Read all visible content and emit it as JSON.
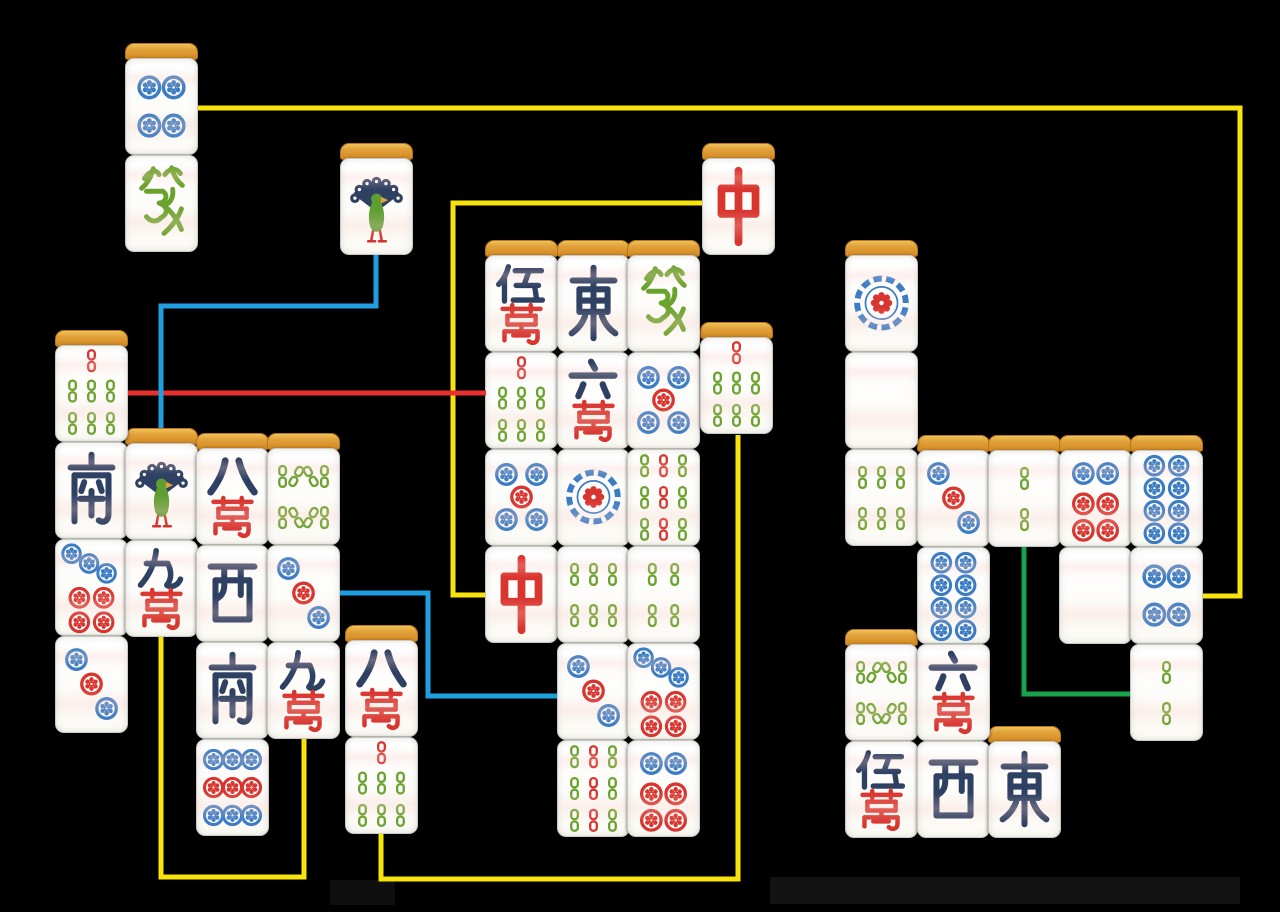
{
  "board": {
    "width": 1280,
    "height": 912,
    "background": "#000000",
    "tile_width": 73,
    "tile_face_height": 97,
    "tile_cap_height": 15
  },
  "palette": {
    "face": "#fdfdfa",
    "cap": "#dd9433",
    "cap_border": "#b5761c",
    "navy": "#2f4163",
    "red": "#d9352f",
    "green": "#6aa32c",
    "bird_green": "#5f9e31",
    "blue": "#3b7cc4",
    "beak_orange": "#e1a33c",
    "leg_red": "#d2332c",
    "line_yellow": "#f8e40a",
    "line_red": "#e8302e",
    "line_blue": "#1f9fe0",
    "line_green": "#18a24c"
  },
  "tiles": [
    {
      "name": "pin-4",
      "label": "4 circles",
      "kind": "pin",
      "value": 4,
      "x": 125,
      "y": 58,
      "cap": true
    },
    {
      "name": "green-dragon",
      "label": "green dragon",
      "kind": "char",
      "char": "發",
      "x": 125,
      "y": 155,
      "cap": false
    },
    {
      "name": "sou-1",
      "label": "1 bamboo bird",
      "kind": "bird",
      "value": 1,
      "x": 340,
      "y": 158,
      "cap": true
    },
    {
      "name": "red-dragon",
      "label": "red dragon",
      "kind": "char",
      "char": "中",
      "x": 702,
      "y": 158,
      "cap": true
    },
    {
      "name": "sou-7",
      "label": "7 bamboo",
      "kind": "sou",
      "value": 7,
      "x": 55,
      "y": 345,
      "cap": true
    },
    {
      "name": "south-wind",
      "label": "south wind",
      "kind": "char",
      "char": "南",
      "x": 55,
      "y": 442,
      "cap": false
    },
    {
      "name": "pin-7",
      "label": "7 circles",
      "kind": "pin",
      "value": 7,
      "x": 55,
      "y": 539,
      "cap": false
    },
    {
      "name": "pin-3",
      "label": "3 circles",
      "kind": "pin",
      "value": 3,
      "x": 55,
      "y": 636,
      "cap": false
    },
    {
      "name": "sou-1",
      "label": "1 bamboo bird",
      "kind": "bird",
      "value": 1,
      "x": 125,
      "y": 443,
      "cap": true
    },
    {
      "name": "man-9",
      "label": "9 characters",
      "kind": "man",
      "num": "九",
      "wan": "萬",
      "x": 125,
      "y": 540,
      "cap": false
    },
    {
      "name": "man-8",
      "label": "8 characters",
      "kind": "man",
      "num": "八",
      "wan": "萬",
      "x": 196,
      "y": 448,
      "cap": true
    },
    {
      "name": "west-wind",
      "label": "west wind",
      "kind": "char",
      "char": "西",
      "x": 196,
      "y": 545,
      "cap": false
    },
    {
      "name": "south-wind",
      "label": "south wind",
      "kind": "char",
      "char": "南",
      "x": 196,
      "y": 642,
      "cap": false
    },
    {
      "name": "pin-9",
      "label": "9 circles",
      "kind": "pin",
      "value": 9,
      "x": 196,
      "y": 739,
      "cap": false
    },
    {
      "name": "sou-8",
      "label": "8 bamboo",
      "kind": "sou",
      "value": 8,
      "x": 267,
      "y": 448,
      "cap": true
    },
    {
      "name": "pin-3",
      "label": "3 circles",
      "kind": "pin",
      "value": 3,
      "x": 267,
      "y": 545,
      "cap": false
    },
    {
      "name": "man-9",
      "label": "9 characters",
      "kind": "man",
      "num": "九",
      "wan": "萬",
      "x": 267,
      "y": 642,
      "cap": false
    },
    {
      "name": "man-8",
      "label": "8 characters",
      "kind": "man",
      "num": "八",
      "wan": "萬",
      "x": 345,
      "y": 640,
      "cap": true
    },
    {
      "name": "sou-7",
      "label": "7 bamboo",
      "kind": "sou",
      "value": 7,
      "x": 345,
      "y": 737,
      "cap": false
    },
    {
      "name": "man-5",
      "label": "5 characters",
      "kind": "man",
      "num": "伍",
      "wan": "萬",
      "x": 485,
      "y": 255,
      "cap": true
    },
    {
      "name": "sou-7",
      "label": "7 bamboo",
      "kind": "sou",
      "value": 7,
      "x": 485,
      "y": 352,
      "cap": false
    },
    {
      "name": "pin-5",
      "label": "5 circles",
      "kind": "pin",
      "value": 5,
      "x": 485,
      "y": 449,
      "cap": false
    },
    {
      "name": "red-dragon",
      "label": "red dragon",
      "kind": "char",
      "char": "中",
      "x": 485,
      "y": 546,
      "cap": false
    },
    {
      "name": "east-wind",
      "label": "east wind",
      "kind": "char",
      "char": "東",
      "x": 557,
      "y": 255,
      "cap": true
    },
    {
      "name": "man-6",
      "label": "6 characters",
      "kind": "man",
      "num": "六",
      "wan": "萬",
      "x": 557,
      "y": 352,
      "cap": false
    },
    {
      "name": "pin-1",
      "label": "1 circle",
      "kind": "pin",
      "value": 1,
      "x": 557,
      "y": 449,
      "cap": false
    },
    {
      "name": "sou-6",
      "label": "6 bamboo",
      "kind": "sou",
      "value": 6,
      "x": 557,
      "y": 546,
      "cap": false
    },
    {
      "name": "pin-3",
      "label": "3 circles",
      "kind": "pin",
      "value": 3,
      "x": 557,
      "y": 643,
      "cap": false
    },
    {
      "name": "sou-9",
      "label": "9 bamboo",
      "kind": "sou",
      "value": 9,
      "x": 557,
      "y": 740,
      "cap": false
    },
    {
      "name": "green-dragon",
      "label": "green dragon",
      "kind": "char",
      "char": "發",
      "x": 627,
      "y": 255,
      "cap": true
    },
    {
      "name": "pin-5",
      "label": "5 circles",
      "kind": "pin",
      "value": 5,
      "x": 627,
      "y": 352,
      "cap": false
    },
    {
      "name": "sou-9",
      "label": "9 bamboo",
      "kind": "sou",
      "value": 9,
      "x": 627,
      "y": 449,
      "cap": false
    },
    {
      "name": "sou-4",
      "label": "4 bamboo",
      "kind": "sou",
      "value": 4,
      "x": 627,
      "y": 546,
      "cap": false
    },
    {
      "name": "pin-7",
      "label": "7 circles",
      "kind": "pin",
      "value": 7,
      "x": 627,
      "y": 643,
      "cap": false
    },
    {
      "name": "pin-6",
      "label": "6 circles",
      "kind": "pin",
      "value": 6,
      "x": 627,
      "y": 740,
      "cap": false
    },
    {
      "name": "sou-7",
      "label": "7 bamboo",
      "kind": "sou",
      "value": 7,
      "x": 700,
      "y": 337,
      "cap": true
    },
    {
      "name": "pin-1",
      "label": "1 circle",
      "kind": "pin",
      "value": 1,
      "x": 845,
      "y": 255,
      "cap": true
    },
    {
      "name": "blank",
      "label": "blank white tile",
      "kind": "blank",
      "x": 845,
      "y": 352,
      "cap": false
    },
    {
      "name": "sou-6",
      "label": "6 bamboo",
      "kind": "sou",
      "value": 6,
      "x": 845,
      "y": 449,
      "cap": false
    },
    {
      "name": "sou-8",
      "label": "8 bamboo",
      "kind": "sou",
      "value": 8,
      "x": 845,
      "y": 644,
      "cap": true
    },
    {
      "name": "man-5",
      "label": "5 characters",
      "kind": "man",
      "num": "伍",
      "wan": "萬",
      "x": 845,
      "y": 741,
      "cap": false
    },
    {
      "name": "pin-3",
      "label": "3 circles",
      "kind": "pin",
      "value": 3,
      "x": 917,
      "y": 450,
      "cap": true
    },
    {
      "name": "pin-8",
      "label": "8 circles",
      "kind": "pin",
      "value": 8,
      "x": 917,
      "y": 547,
      "cap": false
    },
    {
      "name": "man-6",
      "label": "6 characters",
      "kind": "man",
      "num": "六",
      "wan": "萬",
      "x": 917,
      "y": 644,
      "cap": false
    },
    {
      "name": "west-wind",
      "label": "west wind",
      "kind": "char",
      "char": "西",
      "x": 917,
      "y": 741,
      "cap": false
    },
    {
      "name": "sou-2",
      "label": "2 bamboo",
      "kind": "sou",
      "value": 2,
      "x": 988,
      "y": 450,
      "cap": true
    },
    {
      "name": "east-wind",
      "label": "east wind",
      "kind": "char",
      "char": "東",
      "x": 988,
      "y": 741,
      "cap": true
    },
    {
      "name": "pin-6",
      "label": "6 circles",
      "kind": "pin",
      "value": 6,
      "x": 1059,
      "y": 450,
      "cap": true
    },
    {
      "name": "blank",
      "label": "blank white tile",
      "kind": "blank",
      "x": 1059,
      "y": 547,
      "cap": false
    },
    {
      "name": "pin-8",
      "label": "8 circles",
      "kind": "pin",
      "value": 8,
      "x": 1130,
      "y": 450,
      "cap": true
    },
    {
      "name": "pin-4",
      "label": "4 circles",
      "kind": "pin",
      "value": 4,
      "x": 1130,
      "y": 547,
      "cap": false
    },
    {
      "name": "sou-2",
      "label": "2 bamboo",
      "kind": "sou",
      "value": 2,
      "x": 1130,
      "y": 644,
      "cap": false
    }
  ],
  "lines": [
    {
      "name": "match-line-pin4",
      "color": "#f8e40a",
      "points": [
        [
          198,
          108
        ],
        [
          1240,
          108
        ],
        [
          1240,
          596
        ],
        [
          1203,
          596
        ]
      ]
    },
    {
      "name": "match-line-red-dragon",
      "color": "#f8e40a",
      "points": [
        [
          702,
          203
        ],
        [
          453,
          203
        ],
        [
          453,
          595
        ],
        [
          485,
          595
        ]
      ]
    },
    {
      "name": "match-line-man9",
      "color": "#f8e40a",
      "points": [
        [
          161,
          637
        ],
        [
          161,
          877
        ],
        [
          304,
          877
        ],
        [
          304,
          739
        ]
      ]
    },
    {
      "name": "match-line-sou7-b",
      "color": "#f8e40a",
      "points": [
        [
          381,
          834
        ],
        [
          381,
          879
        ],
        [
          738,
          879
        ],
        [
          738,
          435
        ]
      ]
    },
    {
      "name": "match-line-sou7-a",
      "color": "#e8302e",
      "points": [
        [
          128,
          393
        ],
        [
          486,
          393
        ]
      ]
    },
    {
      "name": "match-line-sou1",
      "color": "#1f9fe0",
      "points": [
        [
          376,
          255
        ],
        [
          376,
          306
        ],
        [
          161,
          306
        ],
        [
          161,
          428
        ]
      ]
    },
    {
      "name": "match-line-pin3",
      "color": "#1f9fe0",
      "points": [
        [
          340,
          593
        ],
        [
          428,
          593
        ],
        [
          428,
          696
        ],
        [
          557,
          696
        ]
      ]
    },
    {
      "name": "match-line-sou2",
      "color": "#18a24c",
      "points": [
        [
          1024,
          547
        ],
        [
          1024,
          694
        ],
        [
          1130,
          694
        ]
      ]
    }
  ],
  "shadows": [
    {
      "x": 770,
      "y": 877,
      "w": 470,
      "h": 27,
      "color": "#121212"
    },
    {
      "x": 330,
      "y": 880,
      "w": 65,
      "h": 25,
      "color": "#0f0f0f"
    }
  ]
}
